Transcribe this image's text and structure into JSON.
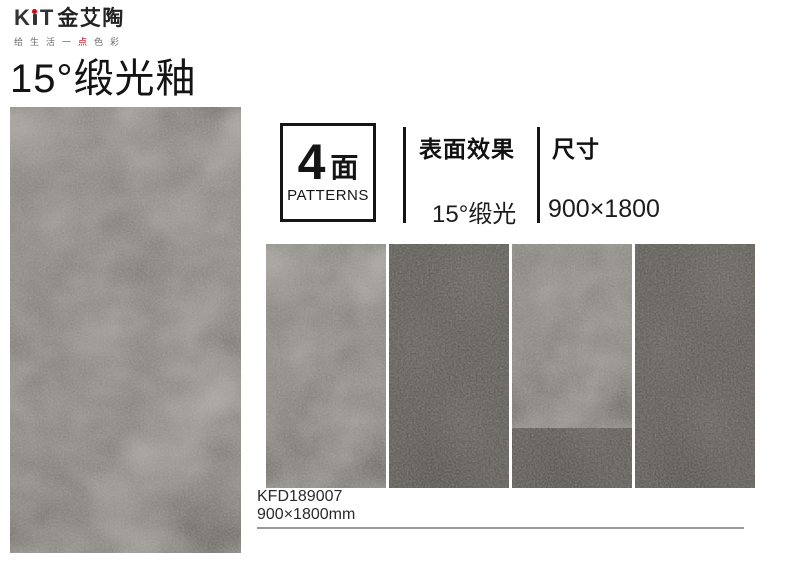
{
  "brand": {
    "name": "KiT金艾陶",
    "letters": {
      "k": "K",
      "t": "T"
    },
    "cn": "金艾陶",
    "tagline": {
      "pre": "给生活一",
      "accent": "点",
      "post": "色彩"
    }
  },
  "page_title": "15°缎光釉",
  "info": {
    "patterns_count": "4",
    "patterns_unit": "面",
    "patterns_label": "PATTERNS",
    "surface_label": "表面效果",
    "surface_value": "15°缎光",
    "size_label": "尺寸",
    "size_value": "900×1800"
  },
  "product": {
    "code": "KFD189007",
    "size": "900×1800mm"
  },
  "colors": {
    "accent_red": "#d7000f",
    "tile_base": "#46423e",
    "text_dark": "#141414",
    "rule_gray": "#9a9a9a"
  }
}
